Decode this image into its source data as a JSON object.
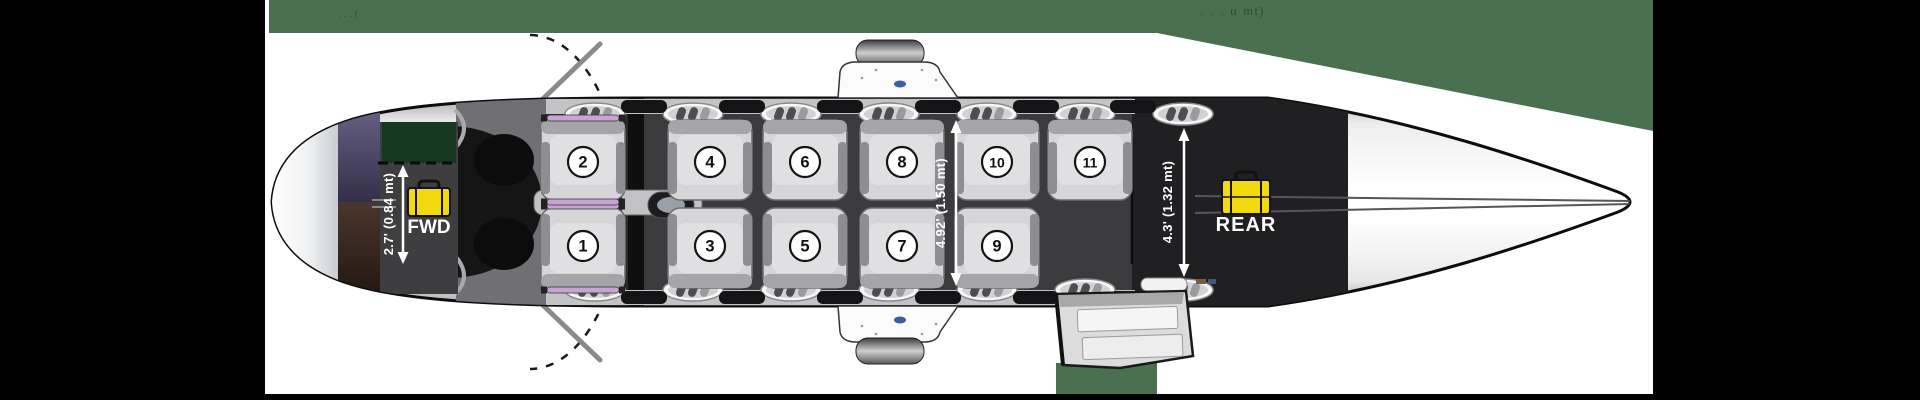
{
  "page": {
    "description": "Top-view aircraft cabin layout diagram with 11 numbered seats, forward and rear baggage compartments, dimension callouts, door swing arc and airstair",
    "colors": {
      "banner_green": "#4A7050",
      "margin_black": "#000000",
      "baggage_yellow": "#F2D90E",
      "divider_green": "#16391F",
      "seat_trim_lavender": "#C9A3D4",
      "cabin_dark": "#3B3B3E",
      "rear_bay_dark": "#202023"
    }
  },
  "header": {
    "top_left_fragment": ". .   . ( .",
    "top_right_fragment": ". .    . u mt)"
  },
  "diagram": {
    "type": "aircraft-top-view-seating",
    "forward_baggage": {
      "label": "FWD",
      "dimension": "2.7' (0.84 mt)",
      "icon": "suitcase-icon"
    },
    "cabin": {
      "dimension": "4.92' (1.50 mt)"
    },
    "rear_baggage": {
      "label": "REAR",
      "dimension": "4.3' (1.32 mt)",
      "icon": "suitcase-icon"
    },
    "seats": [
      {
        "number": "1",
        "row": "bottom",
        "col": 1
      },
      {
        "number": "2",
        "row": "top",
        "col": 1
      },
      {
        "number": "3",
        "row": "bottom",
        "col": 2
      },
      {
        "number": "4",
        "row": "top",
        "col": 2
      },
      {
        "number": "5",
        "row": "bottom",
        "col": 3
      },
      {
        "number": "6",
        "row": "top",
        "col": 3
      },
      {
        "number": "7",
        "row": "bottom",
        "col": 4
      },
      {
        "number": "8",
        "row": "top",
        "col": 4
      },
      {
        "number": "9",
        "row": "bottom",
        "col": 5
      },
      {
        "number": "10",
        "row": "top",
        "col": 5
      },
      {
        "number": "11",
        "row": "top",
        "col": 6
      }
    ]
  }
}
